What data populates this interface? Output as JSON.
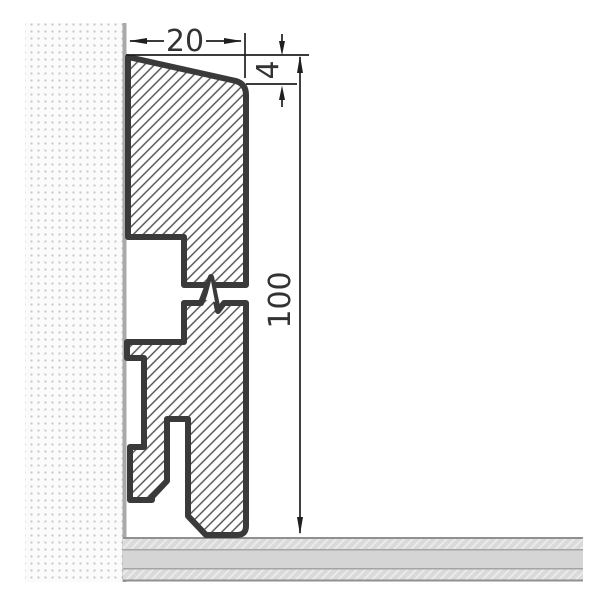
{
  "dimension_labels": {
    "width": "20",
    "chamfer": "4",
    "height": "100"
  },
  "colors": {
    "outline": "#3a3a3a",
    "hatch_line": "#4d4d4d",
    "dimension_line": "#1f1f1f",
    "label_text": "#333333",
    "wall_background": "#fbfbfb",
    "wall_dot": "#c7c7c7",
    "wall_edge": "#a9a9a9",
    "floor_solid": "#d5d5d5",
    "floor_hatch_background": "#dadada",
    "floor_hatch_line": "#eeeeee",
    "floor_border": "#909090",
    "canvas_background": "#ffffff"
  }
}
